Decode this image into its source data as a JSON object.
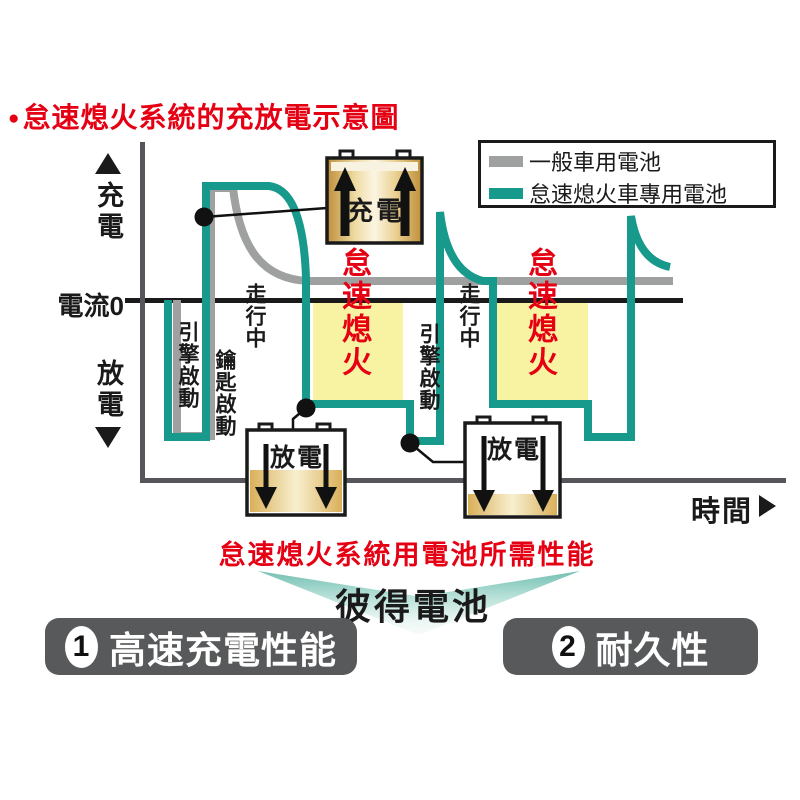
{
  "title": {
    "bullet": "●",
    "text": "怠速熄火系統的充放電示意圖",
    "color": "#E50013"
  },
  "legend": {
    "items": [
      {
        "label": "一般車用電池",
        "swatch_color": "#9FA0A0"
      },
      {
        "label": "怠速熄火車專用電池",
        "swatch_color": "#179A8C"
      }
    ]
  },
  "y_axis": {
    "charge_label": "充電",
    "zero_label": "電流0",
    "discharge_label": "放電"
  },
  "x_axis": {
    "label": "時間"
  },
  "phases": {
    "engine_start_1": "引擎啟動",
    "key_start": "鑰匙啟動",
    "driving_1": "走行中",
    "idle_stop_1": "怠速熄火",
    "engine_start_2": "引擎啟動",
    "driving_2": "走行中",
    "idle_stop_2": "怠速熄火"
  },
  "battery_callouts": {
    "charging": "充電",
    "discharging_1": "放電",
    "discharging_2": "放電"
  },
  "subtitle": "怠速熄火系統用電池所需性能",
  "brand": "彼得電池",
  "features": [
    {
      "number": "1",
      "label": "高速充電性能"
    },
    {
      "number": "2",
      "label": "耐久性"
    }
  ],
  "colors": {
    "accent_red": "#E50013",
    "teal_series": "#179A8C",
    "gray_series": "#9FA0A0",
    "idle_highlight": "#F8F3A3",
    "axis_gray": "#54565A",
    "zero_line": "#1A1A1A",
    "feature_button_bg": "#58595B",
    "battery_gold": "#BE8F3A",
    "chevron_teal": "#74C0B2"
  },
  "chart_data": {
    "type": "line",
    "title": "怠速熄火系統的充放電示意圖",
    "xlabel": "時間",
    "ylabel": "充電 / 電流0 / 放電 (relative, no numeric ticks shown)",
    "legend_position": "top-right",
    "series": [
      {
        "name": "一般車用電池",
        "color": "#9FA0A0",
        "shape_px_points": [
          [
            177,
            300
          ],
          [
            177,
            436
          ],
          [
            211,
            436
          ],
          [
            211,
            188
          ],
          [
            233,
            188
          ],
          [
            308,
            281
          ],
          [
            673,
            281
          ]
        ],
        "description_labels": [
          "引擎啟動",
          "走行中"
        ]
      },
      {
        "name": "怠速熄火車專用電池",
        "color": "#179A8C",
        "shape_px_points": [
          [
            168,
            300
          ],
          [
            168,
            437
          ],
          [
            206,
            437
          ],
          [
            206,
            186
          ],
          [
            269,
            186
          ],
          [
            306,
            278
          ],
          [
            306,
            404
          ],
          [
            410,
            404
          ],
          [
            410,
            441
          ],
          [
            440,
            441
          ],
          [
            440,
            212
          ],
          [
            483,
            281
          ],
          [
            493,
            281
          ],
          [
            493,
            404
          ],
          [
            588,
            404
          ],
          [
            588,
            437
          ],
          [
            631,
            437
          ],
          [
            631,
            216
          ],
          [
            670,
            267
          ]
        ],
        "description_labels": [
          "鑰匙啟動",
          "充電",
          "怠速熄火",
          "放電",
          "引擎啟動",
          "走行中"
        ]
      }
    ],
    "highlight_zones": [
      {
        "label": "怠速熄火",
        "x_px": [
          313,
          403
        ],
        "y_px": [
          303,
          400
        ],
        "color": "#F8F3A3"
      },
      {
        "label": "怠速熄火",
        "x_px": [
          497,
          588
        ],
        "y_px": [
          303,
          400
        ],
        "color": "#F8F3A3"
      }
    ]
  }
}
